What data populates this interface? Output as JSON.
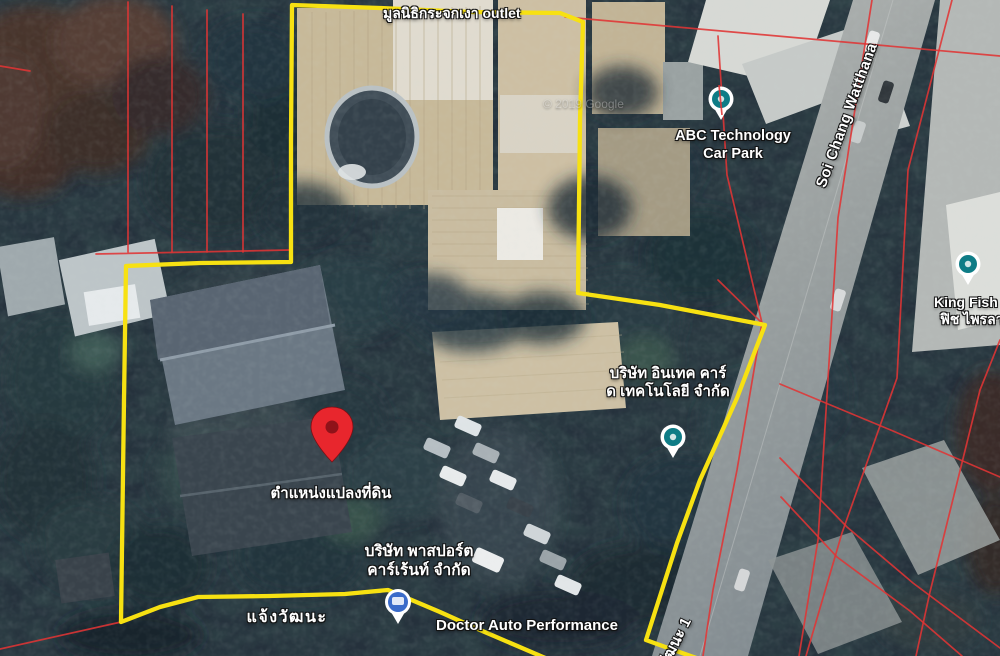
{
  "map": {
    "watermark": "© 2019 Google",
    "poi": {
      "foundation": "มูลนิธิกระจกเงา outlet",
      "abc_line1": "ABC Technology",
      "abc_line2": "Car Park",
      "kingfish_line1": "King Fish",
      "kingfish_line2": "ฟิช ไพรลา",
      "intech_line1": "บริษัท อินเทค คาร์",
      "intech_line2": "ด เทคโนโลยี จำกัด",
      "passport_line1": "บริษัท พาสปอร์ต",
      "passport_line2": "คาร์เร้นท์ จำกัด",
      "doctor_auto": "Doctor Auto Performance"
    },
    "roads": {
      "soi_chang_watthana": "Soi Chang Watthana",
      "chaeng_watthana": "แจ้งวัฒนะ",
      "watthana_1": "วัฒนะ 1"
    },
    "marker": {
      "plot_label": "ตำแหน่งแปลงที่ดิน"
    },
    "colors": {
      "boundary_yellow": "#f7e112",
      "cadastral_red": "#e03434",
      "pin_red": "#e8262d",
      "poi_teal": "#0e7c86",
      "poi_blue": "#3a6bc9"
    },
    "icons": {
      "plot_pin": "red-map-pin",
      "poi_pin": "teal-circle-poi",
      "passport_pin": "blue-circle-poi"
    }
  }
}
